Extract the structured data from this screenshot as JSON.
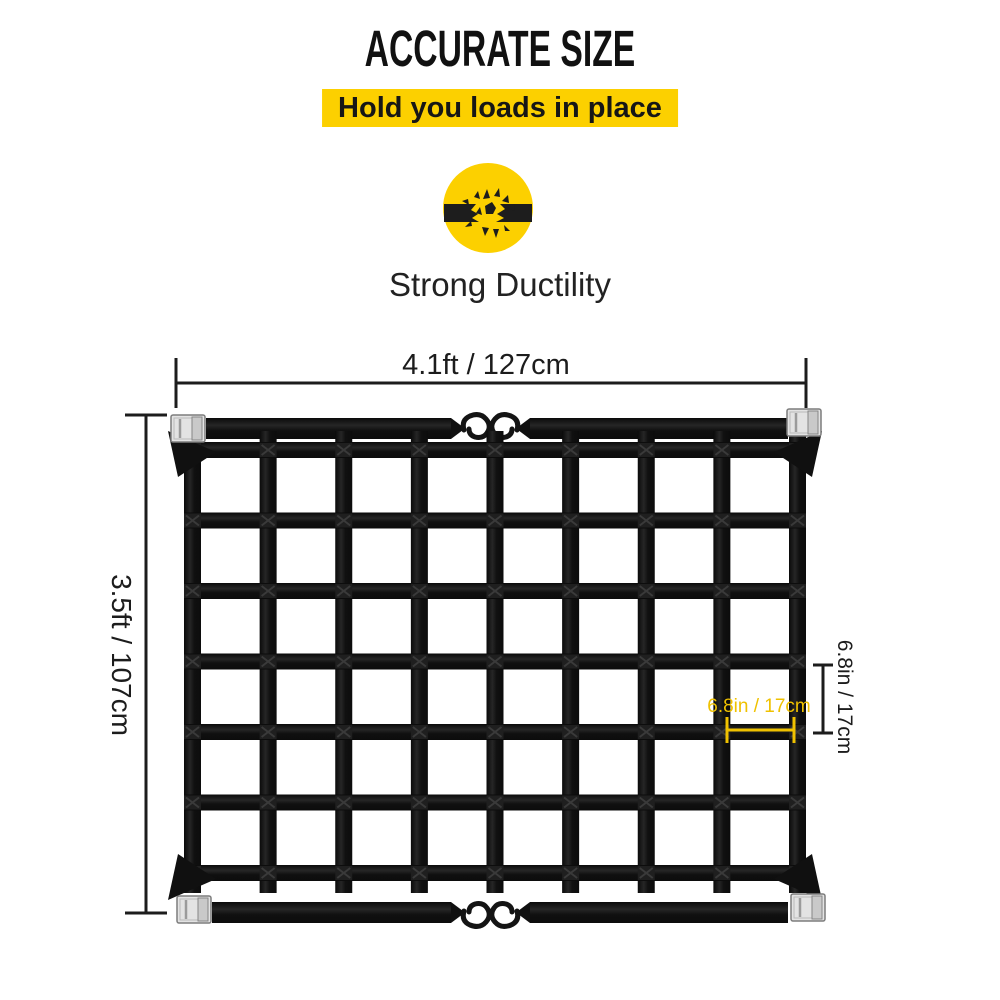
{
  "header": {
    "title": "ACCURATE SIZE",
    "subtitle": "Hold you loads in place"
  },
  "feature": {
    "label": "Strong Ductility",
    "icon": "broken-strap-burst-icon"
  },
  "figure": {
    "width_label": "4.1ft / 127cm",
    "height_label": "3.5ft / 107cm",
    "cell_height_label": "6.8in / 17cm",
    "cell_width_label": "6.8in / 17cm"
  },
  "net": {
    "mesh_columns": 8,
    "mesh_rows": 6,
    "vertical_straps": 9,
    "horizontal_straps": 7,
    "corner_cam_buckles": 4,
    "center_s_hooks": 4
  },
  "colors": {
    "accent_yellow": "#FCD000",
    "annotation_yellow": "#EFC100",
    "ink": "#1C1C1C",
    "net_black": "#141414",
    "buckle_silver": "#E3E3E3"
  }
}
